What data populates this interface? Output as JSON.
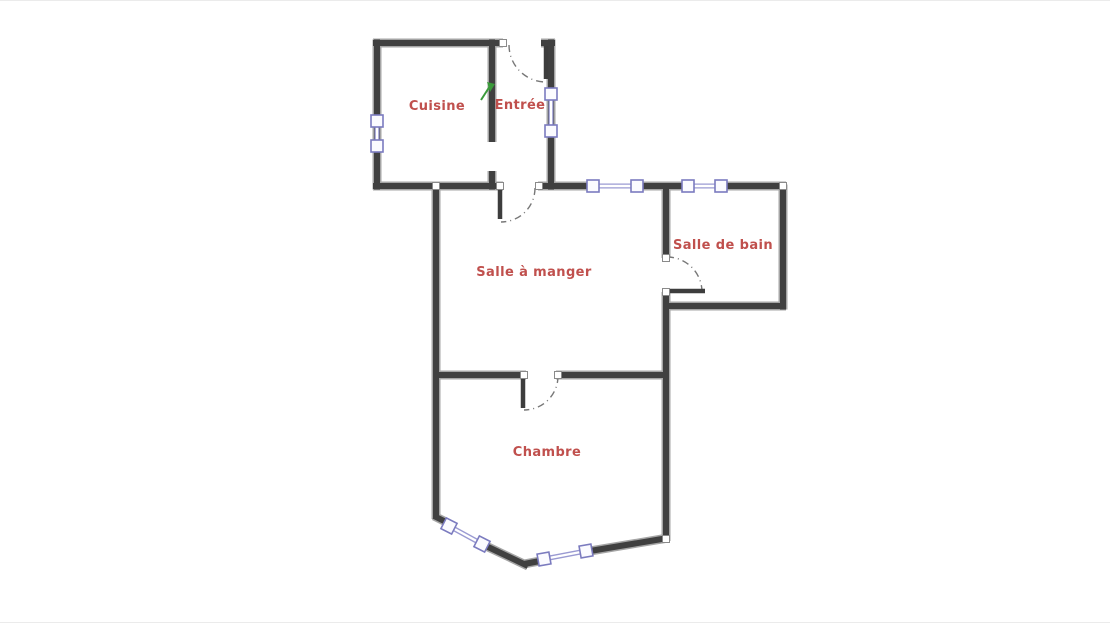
{
  "title": "Floor plan",
  "rooms": {
    "cuisine": {
      "label": "Cuisine"
    },
    "entree": {
      "label": "Entrée"
    },
    "salle_a_manger": {
      "label": "Salle à manger"
    },
    "salle_de_bain": {
      "label": "Salle de bain"
    },
    "chambre": {
      "label": "Chambre"
    }
  },
  "icons": {
    "entrance_marker": "green-arrow-icon",
    "window_symbol": "window-icon",
    "door_swing": "door-arc-icon"
  },
  "colors": {
    "background": "#ffffff",
    "wall": "#404040",
    "wall_edge": "#a5a5a5",
    "door_leaf": "#3d3d3d",
    "door_arc": "#777777",
    "window_frame": "#7b7bbf",
    "window_band": "#9a9ad2",
    "window_fill": "#fbfbff",
    "node_border": "#8a8a8a",
    "label": "#c0504d",
    "marker": "#3a9a3a"
  }
}
